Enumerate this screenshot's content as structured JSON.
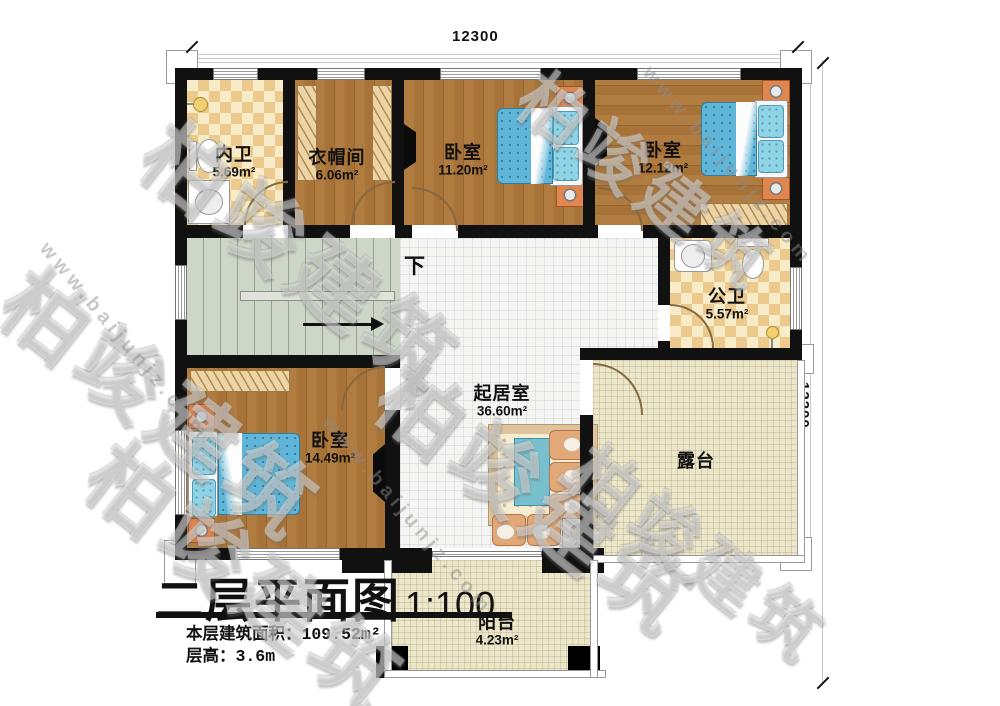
{
  "dimensions": {
    "top": "12300",
    "right": "12200"
  },
  "title": {
    "main": "二层平面图",
    "scale": "1:100",
    "area_label": "本层建筑面积：",
    "area_value": "109.52m²",
    "height_label": "层高：",
    "height_value": "3.6m"
  },
  "stairs": {
    "label": "下"
  },
  "rooms": {
    "neiwei": {
      "name": "内卫",
      "area": "5.69m²"
    },
    "yimaojian": {
      "name": "衣帽间",
      "area": "6.06m²"
    },
    "woshi1": {
      "name": "卧室",
      "area": "11.20m²"
    },
    "woshi2": {
      "name": "卧室",
      "area": "12.12m²"
    },
    "gongwei": {
      "name": "公卫",
      "area": "5.57m²"
    },
    "qijushi": {
      "name": "起居室",
      "area": "36.60m²"
    },
    "woshi3": {
      "name": "卧室",
      "area": "14.49m²"
    },
    "lutai": {
      "name": "露台"
    },
    "yangtai": {
      "name": "阳台",
      "area": "4.23m²"
    }
  },
  "watermark": {
    "brand": "柏竣建筑",
    "url": "www.baijunjz.com"
  },
  "colors": {
    "wall": "#111111",
    "wood": "#a87338",
    "tile_light": "#f8ecc8",
    "tile_dark": "#ecca8e",
    "stair": "#ced6c8",
    "outdoor": "#ece6cb",
    "living": "#f4f5f2",
    "bed": "#5fb6d8"
  }
}
